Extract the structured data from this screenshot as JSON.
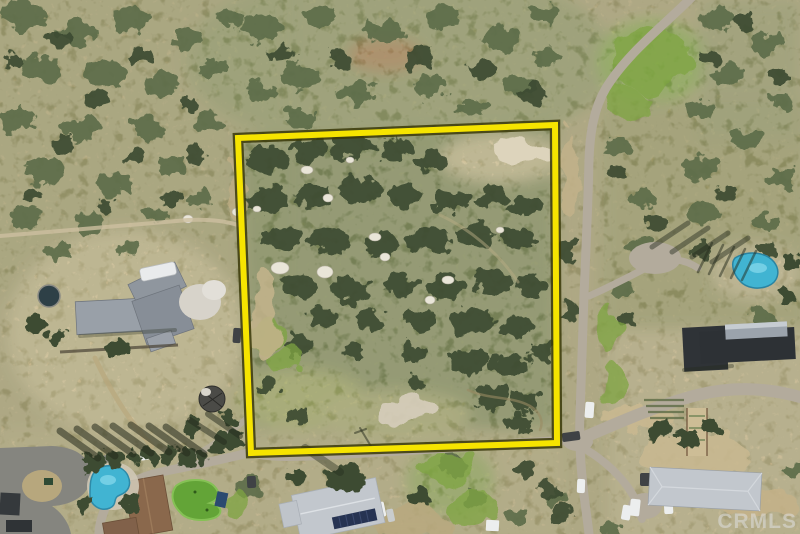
{
  "meta": {
    "kind": "aerial-drone-photograph",
    "width": 800,
    "height": 534
  },
  "watermark": {
    "text": "CRMLS",
    "color": "#dedede",
    "opacity": 0.55
  },
  "overlay": {
    "boundary_points": "238,138 555,125 557,443 251,453",
    "boundary_color": "#f6e400",
    "boundary_outline": "#3a3808"
  },
  "palette": {
    "dirt_base": "#ab9e74",
    "scrub_dark": "#3c4c30",
    "scrub_mid": "#5c6c48",
    "grass_bright": "#7fa542",
    "grass_yellow": "#a3a862",
    "road_gray": "#b3ab9c",
    "asphalt": "#85857f",
    "roof_gray": "#99a0a8",
    "roof_light": "#c2c7cd",
    "roof_dark": "#2f3337",
    "roof_metal": "#9ba3ac",
    "roof_brown": "#8a684c",
    "solar_panel": "#263352",
    "pool_blue": "#41b4d2",
    "pool_light": "#7fd6ea",
    "green_turf": "#63a437",
    "boulder": "#e9e5d8",
    "shadow": "#242a1c",
    "vehicle_white": "#eceeee",
    "vehicle_dark": "#3f4245"
  },
  "scene": {
    "subject": "Vacant chaparral land parcel outlined with yellow lot lines",
    "features": [
      "chaparral scrub hillside",
      "dirt roads",
      "granite boulders",
      "neighboring rural homes",
      "swimming pools",
      "backyard putting green",
      "solar panel roof",
      "round stock-tank pool",
      "parked vehicles"
    ]
  }
}
